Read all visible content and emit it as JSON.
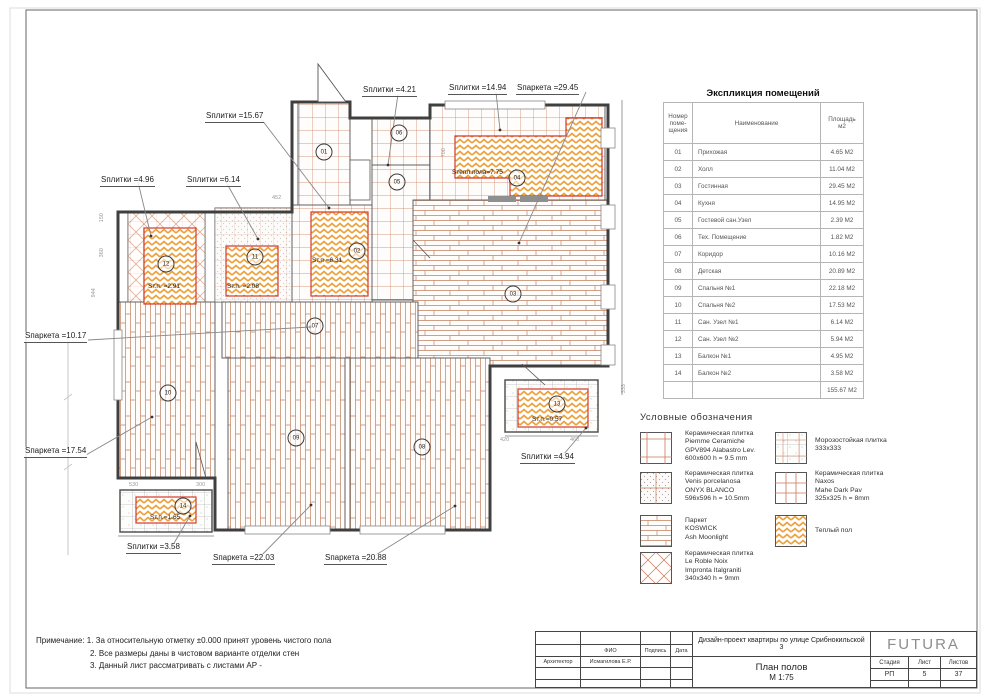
{
  "plan": {
    "area_labels": [
      {
        "text": "Sплитки =15.67"
      },
      {
        "text": "Sплитки =4.21"
      },
      {
        "text": "Sплитки =14.94"
      },
      {
        "text": "Sпаркета =29.45"
      },
      {
        "text": "Sплитки =4.96"
      },
      {
        "text": "Sплитки =6.14"
      },
      {
        "text": "Sпаркета =10.17"
      },
      {
        "text": "Sпаркета =17.54"
      },
      {
        "text": "Sплитки =4.94"
      },
      {
        "text": "Sплитки =3.58"
      },
      {
        "text": "Sпаркета =22.03"
      },
      {
        "text": "Sпаркета =20.88"
      }
    ],
    "inline_labels": [
      {
        "text": "Sтепл.пола=7.75"
      },
      {
        "text": "Sт.п. =2.91"
      },
      {
        "text": "Sт.п. =2.08"
      },
      {
        "text": "Sт.п =6.31"
      },
      {
        "text": "Sт.п.=0.57"
      },
      {
        "text": "Sт.п.=1.65"
      }
    ],
    "rooms": [
      "01",
      "02",
      "03",
      "04",
      "05",
      "06",
      "07",
      "08",
      "09",
      "10",
      "11",
      "12",
      "13",
      "14"
    ],
    "dimensions": [
      "150",
      "360",
      "944",
      "452",
      "700",
      "530",
      "300",
      "420",
      "460",
      "333"
    ]
  },
  "schedule": {
    "title": "Экспликция помещений",
    "col1": "Номер\nпоме-\nщения",
    "col2": "Наименование",
    "col3": "Площадь\nм2",
    "rows": [
      [
        "01",
        "Прихожая",
        "4.65 М2"
      ],
      [
        "02",
        "Холл",
        "11.04 М2"
      ],
      [
        "03",
        "Гостинная",
        "29.45 М2"
      ],
      [
        "04",
        "Кухня",
        "14.95 М2"
      ],
      [
        "05",
        "Гостевой сан.Узел",
        "2.39 М2"
      ],
      [
        "06",
        "Тех. Помещение",
        "1.82 М2"
      ],
      [
        "07",
        "Коридор",
        "10.16 М2"
      ],
      [
        "08",
        "Детская",
        "20.89 М2"
      ],
      [
        "09",
        "Спальня №1",
        "22.18 М2"
      ],
      [
        "10",
        "Спальня №2",
        "17.53 М2"
      ],
      [
        "11",
        "Сан. Узел №1",
        "6.14 М2"
      ],
      [
        "12",
        "Сан. Узел №2",
        "5.94 М2"
      ],
      [
        "13",
        "Балкон №1",
        "4.95 М2"
      ],
      [
        "14",
        "Балкон №2",
        "3.58 М2"
      ]
    ],
    "total": "155.67 М2"
  },
  "legend": {
    "title": "Условные обозначения",
    "items": [
      {
        "text": "Керамическая плитка\nPiemme Ceramiche\nGPV894 Alabastro Lev.\n600x600 h = 9.5 mm"
      },
      {
        "text": "Керамическая плитка\nVenis porcelanosa\nONYX BLANCO\n596x596 h = 10.5mm"
      },
      {
        "text": "Паркет\nKOSWICK\nAsh Moonlight"
      },
      {
        "text": "Керамическая плитка\nLe Roble Noix\nImpronta Italgraniti\n340x340 h = 9mm"
      },
      {
        "text": "Морозостойкая плитка\n333x333"
      },
      {
        "text": "Керамическая плитка\nNaxos\nMahe Dark Pav\n325x325 h = 8mm"
      },
      {
        "text": "Теплый пол"
      }
    ]
  },
  "notes": {
    "line1": "Примечание: 1. За относительную отметку ±0.000 принят уровень чистого пола",
    "line2": "2. Все размеры даны в чистовом варианте отделки стен",
    "line3": "3. Данный лист рассматривать с листами АР -"
  },
  "title_block": {
    "fio_header": "ФИО",
    "podpis_header": "Подпись",
    "data_header": "Дата",
    "role": "Архитектор",
    "architect": "Исмагилова Е.Р.",
    "project": "Дизайн-проект квартиры по улице Срибнокильской 3",
    "sheet_title": "План полов",
    "scale": "М 1:75",
    "stage_header": "Стадия",
    "sheet_header": "Лист",
    "sheets_header": "Листов",
    "stage": "РП",
    "sheet_num": "5",
    "sheets_total": "37",
    "logo": "FUTURA"
  },
  "colors": {
    "hatch": "#c9795b",
    "parquet": "#c2805f",
    "warm": "#eda03c",
    "warm_border": "#d33a2a",
    "wall": "#3f3f3f"
  }
}
